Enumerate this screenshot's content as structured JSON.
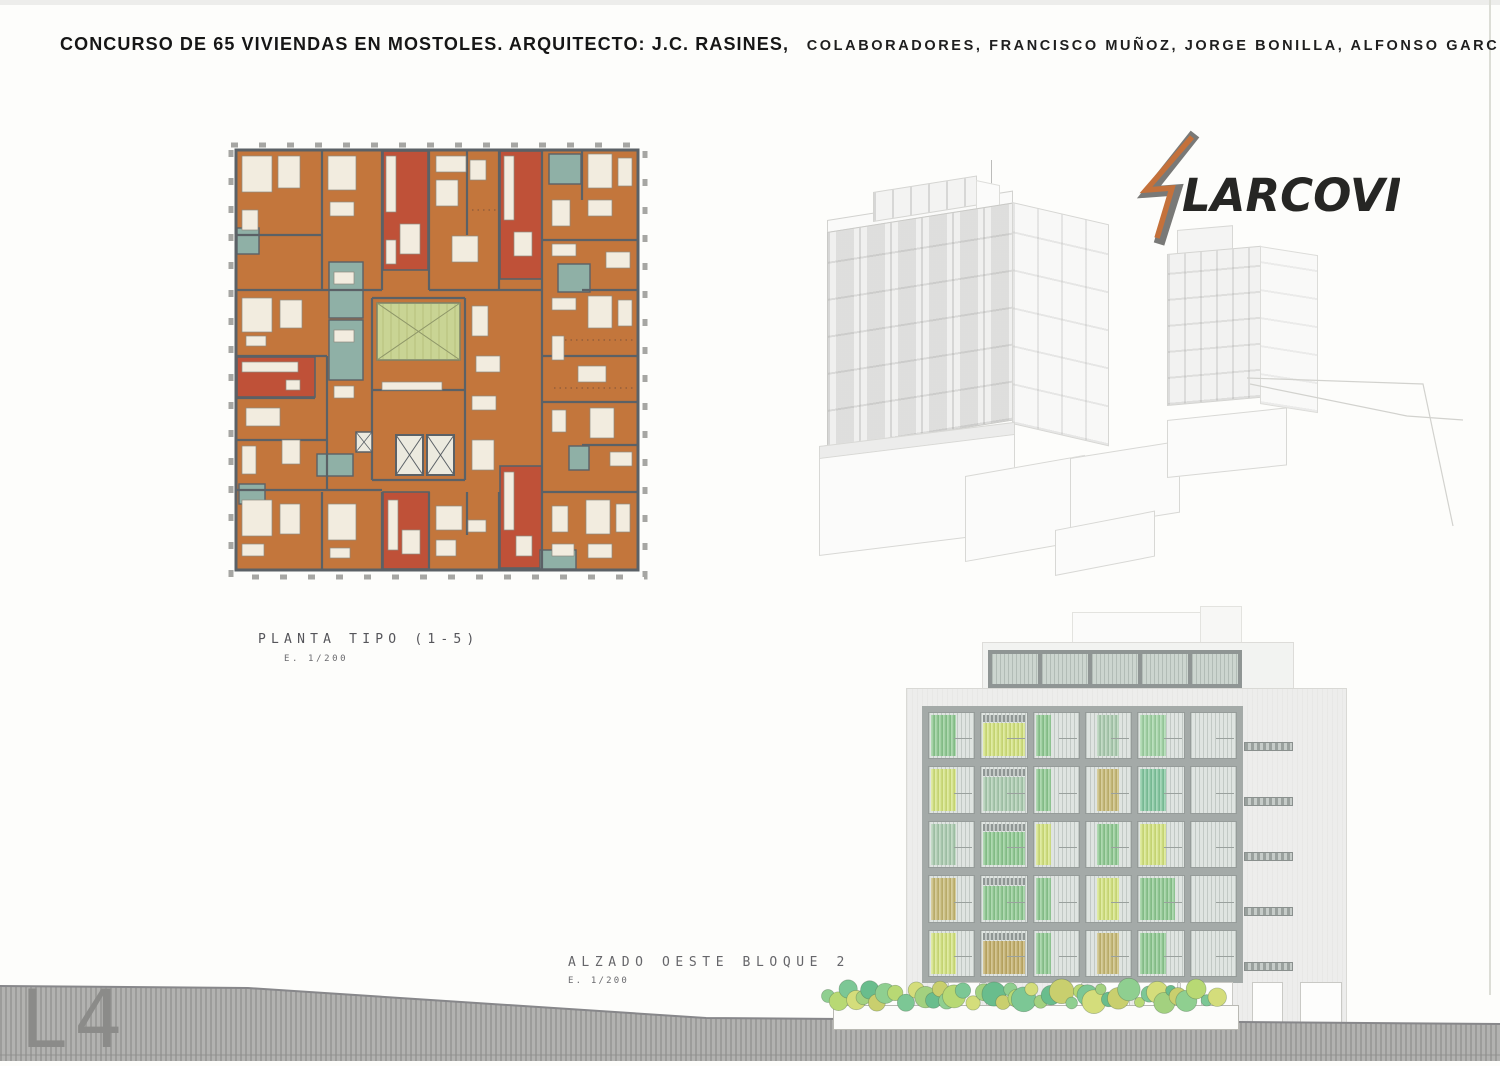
{
  "header": {
    "title_main": "CONCURSO DE 65 VIVIENDAS EN MOSTOLES. ARQUITECTO: J.C. RASINES,",
    "title_collaborators": "COLABORADORES, FRANCISCO MUÑOZ, JORGE BONILLA, ALFONSO GARCIA, LUIS CABAU"
  },
  "sheet": {
    "number": "L4"
  },
  "floor_plan": {
    "label": "PLANTA TIPO (1-5)",
    "scale": "E. 1/200"
  },
  "render_3d": {
    "brand": "LARCOVI",
    "logo_orange": "#c4713b",
    "logo_grey": "#6a6a68"
  },
  "elevation": {
    "label": "ALZADO OESTE BLOQUE 2",
    "scale": "E. 1/200",
    "palette": {
      "green": "#8cc98f",
      "green2": "#9ed3a2",
      "yellowgreen": "#d3e37b",
      "sage": "#a9cbae",
      "olive": "#c6b871",
      "teal": "#7fc69d",
      "olive2": "#c2ad66"
    },
    "facade_grid": {
      "rows": 5,
      "cols": 6,
      "cells": [
        [
          "left:green",
          "full:yellowgreen",
          "narrow:green",
          "center:sage",
          "left:green2",
          "none"
        ],
        [
          "left:yellowgreen",
          "full:sage",
          "narrow:green",
          "center:olive",
          "left:teal",
          "none"
        ],
        [
          "left:sage",
          "full:green",
          "narrow:yellowgreen",
          "center:green",
          "left:yellowgreen",
          "none"
        ],
        [
          "left:olive",
          "full:green",
          "narrow:green",
          "center:yellowgreen",
          "wide:green",
          "none"
        ],
        [
          "left:yellowgreen",
          "full:olive2",
          "narrow:green",
          "center:olive",
          "left:green",
          "none"
        ]
      ]
    }
  }
}
